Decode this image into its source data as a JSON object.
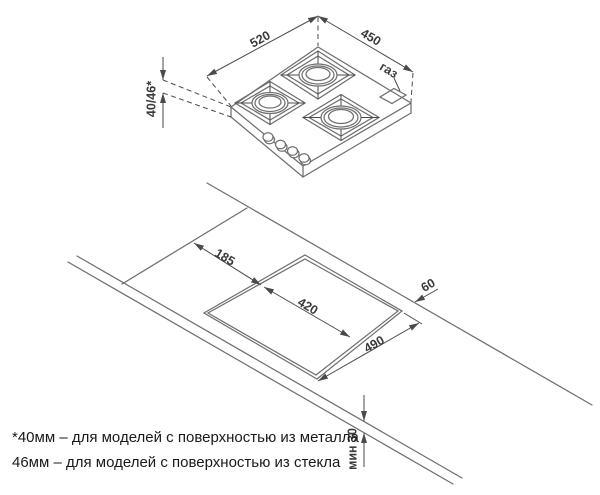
{
  "diagram": {
    "title_hint": "gas hob installation dimensions",
    "hob": {
      "dim_width": "520",
      "dim_depth": "450",
      "dim_height": "40/46*",
      "gas_label": "газ"
    },
    "cutout": {
      "dim_side_offset": "185",
      "dim_depth": "420",
      "dim_width": "490",
      "dim_back_offset": "60",
      "dim_min_thickness": "мин 30"
    },
    "footnote": {
      "line1": "*40мм – для моделей с поверхностью из металла",
      "line2": "46мм – для моделей с поверхностью из стекла"
    },
    "colors": {
      "line": "#6f6f6f",
      "dim_line": "#4a4a4a",
      "dim_text": "#3a3a3a",
      "footnote_text": "#1a1a1a",
      "background": "#ffffff"
    }
  }
}
